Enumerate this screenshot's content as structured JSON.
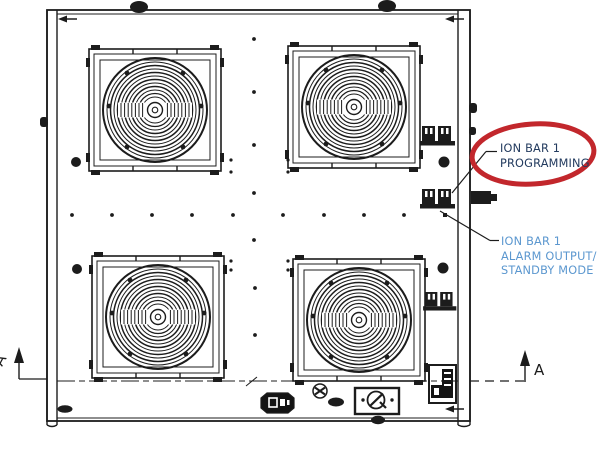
{
  "colors": {
    "line": "#1c1c1c",
    "red_highlight": "#c2272c",
    "navy": "#223a5e",
    "blue": "#5b97cf"
  },
  "callouts": {
    "programming": {
      "lines": [
        "ION BAR 1",
        "PROGRAMMING"
      ]
    },
    "alarm": {
      "lines": [
        "ION BAR 1",
        "ALARM OUTPUT/",
        "STANDBY MODE"
      ]
    }
  },
  "section_markers": {
    "left": "A",
    "right": "A"
  }
}
